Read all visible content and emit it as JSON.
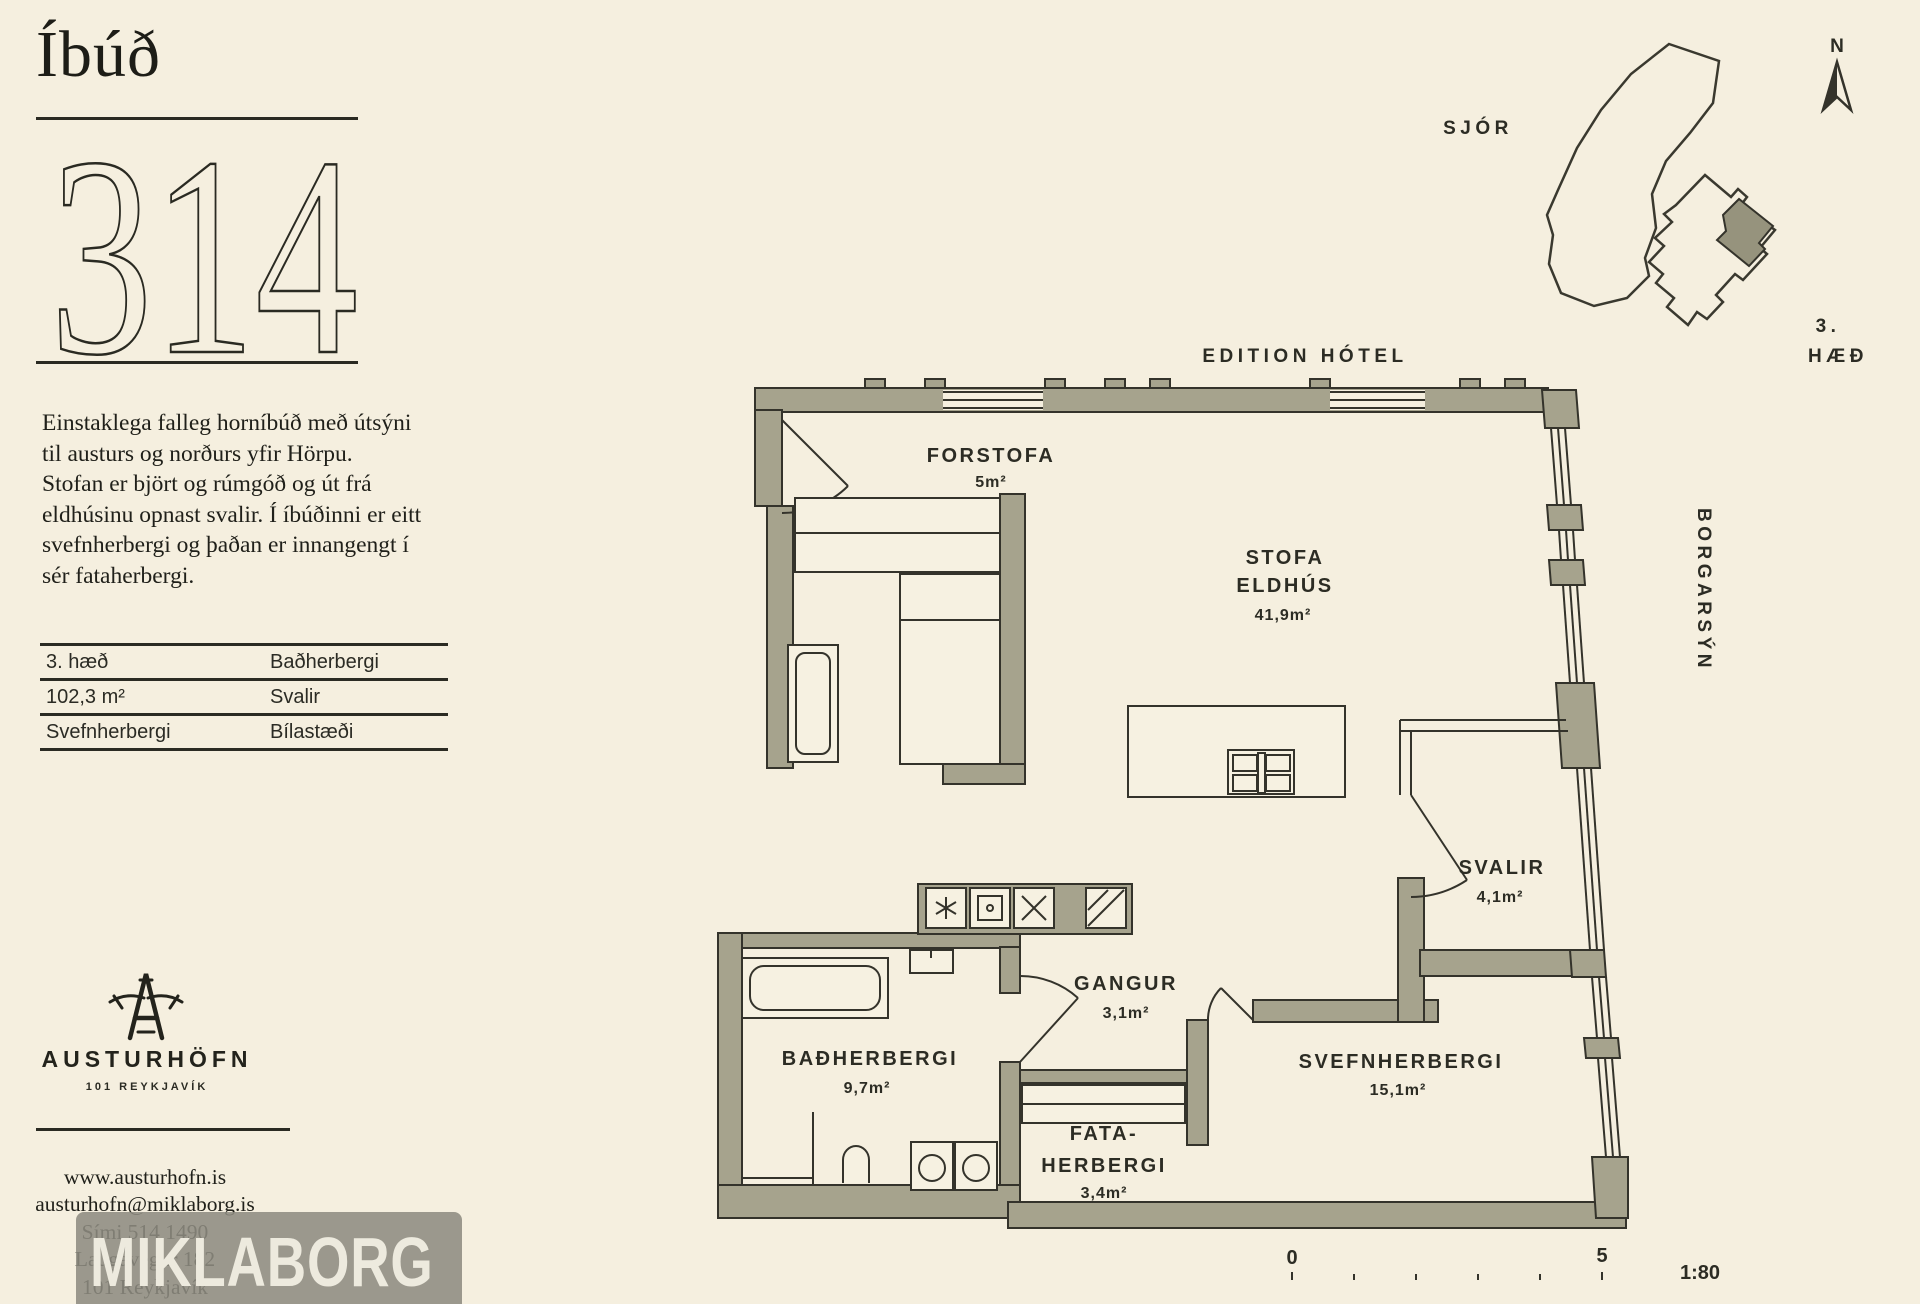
{
  "page": {
    "background": "#f5efdf",
    "ink": "#23231c",
    "wall_color": "#a6a38d",
    "line_color": "#34332b"
  },
  "header": {
    "title": "Íbúð",
    "number": "314"
  },
  "description": {
    "lines": [
      "Einstaklega falleg horníbúð með útsýni",
      "til austurs og norðurs yfir Hörpu.",
      "Stofan er björt og rúmgóð og út frá",
      "eldhúsinu opnast svalir. Í íbúðinni er eitt",
      "svefnherbergi og þaðan er innangengt í",
      "sér fataherbergi."
    ]
  },
  "facts": {
    "rows": [
      [
        "3. hæð",
        "Baðherbergi"
      ],
      [
        "102,3 m²",
        "Svalir"
      ],
      [
        "Svefnherbergi",
        "Bílastæði"
      ]
    ]
  },
  "brand": {
    "name": "AUSTURHÖFN",
    "location": "101 REYKJAVÍK"
  },
  "contact": {
    "lines": [
      "www.austurhofn.is",
      "austurhofn@miklaborg.is",
      "Sími 514 1490",
      "Laugavegur 182",
      "101 Reykjavík"
    ]
  },
  "agency": {
    "name": "MIKLABORG"
  },
  "plan": {
    "hotel_label": "EDITION HÓTEL",
    "sea_label": "SJÓR",
    "street_label": "BORGARSÝN",
    "north_label": "N",
    "floor_label_1": "3.",
    "floor_label_2": "HÆÐ",
    "rooms": [
      {
        "name": "FORSTOFA",
        "area": "5m²"
      },
      {
        "name": "STOFA",
        "name2": "ELDHÚS",
        "area": "41,9m²"
      },
      {
        "name": "SVALIR",
        "area": "4,1m²"
      },
      {
        "name": "GANGUR",
        "area": "3,1m²"
      },
      {
        "name": "BAÐHERBERGI",
        "area": "9,7m²"
      },
      {
        "name": "FATA-",
        "name2": "HERBERGI",
        "area": "3,4m²"
      },
      {
        "name": "SVEFNHERBERGI",
        "area": "15,1m²"
      }
    ],
    "scale": {
      "start": "0",
      "end": "5",
      "ratio": "1:80"
    }
  }
}
